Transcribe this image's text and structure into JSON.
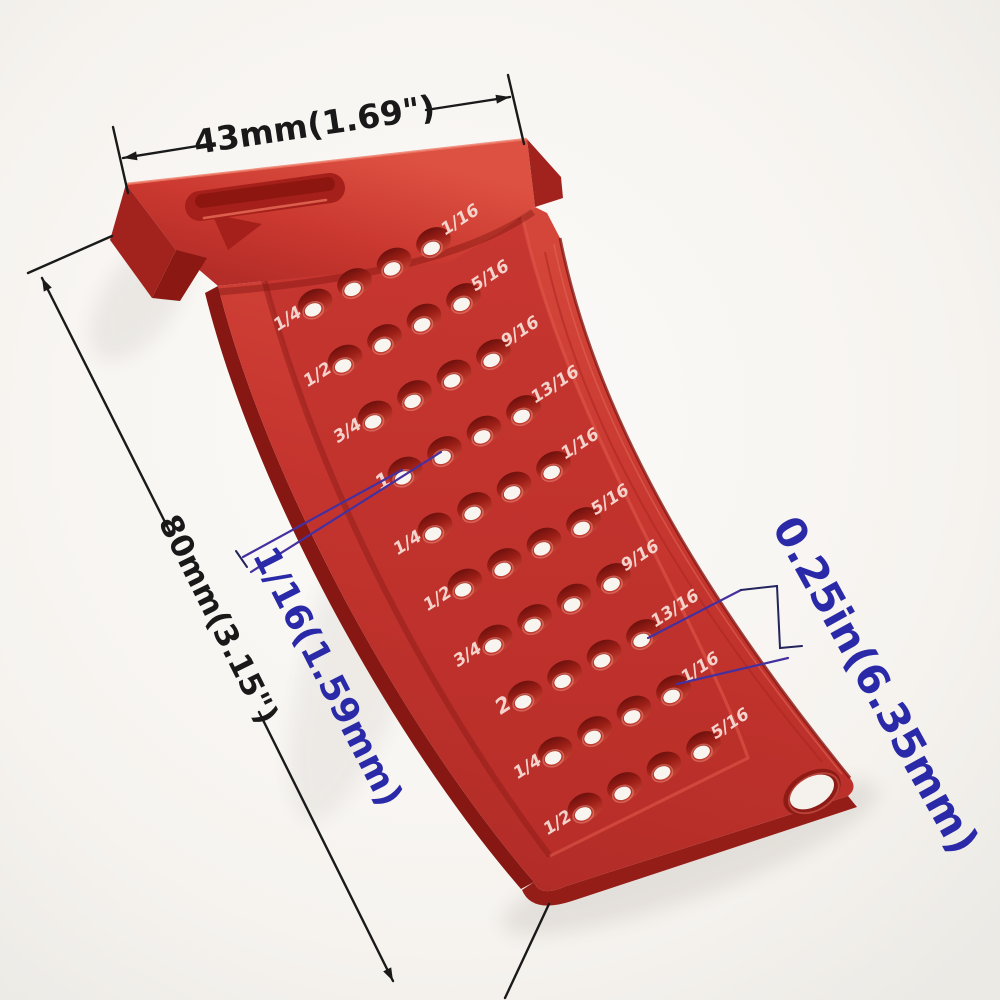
{
  "annotations": {
    "head_width": "43mm(1.69\")",
    "body_length": "80mm(3.15\")",
    "hole_spacing": "1/16(1.59mm)",
    "hole_size": "0.25in(6.35mm)"
  },
  "ruler": {
    "holes_per_row": 4,
    "rows": [
      {
        "left": "1/4",
        "right": "1/16"
      },
      {
        "left": "1/2",
        "right": "5/16"
      },
      {
        "left": "3/4",
        "right": "9/16"
      },
      {
        "left": "1",
        "right": "13/16"
      },
      {
        "left": "1/4",
        "right": "1/16"
      },
      {
        "left": "1/2",
        "right": "5/16"
      },
      {
        "left": "3/4",
        "right": "9/16"
      },
      {
        "left": "2",
        "right": "13/16"
      },
      {
        "left": "1/4",
        "right": "1/16"
      },
      {
        "left": "1/2",
        "right": "5/16"
      }
    ]
  },
  "colors": {
    "tool_red": "#c6332d",
    "tool_red_dark": "#8c1712",
    "tool_red_light": "#d84a3e",
    "dimension_black": "#1a1a1a",
    "annotation_blue": "#2a2aa8",
    "leader_purple": "#45309f",
    "label_white": "#f6dcd4",
    "background": "#f6f4f0"
  }
}
